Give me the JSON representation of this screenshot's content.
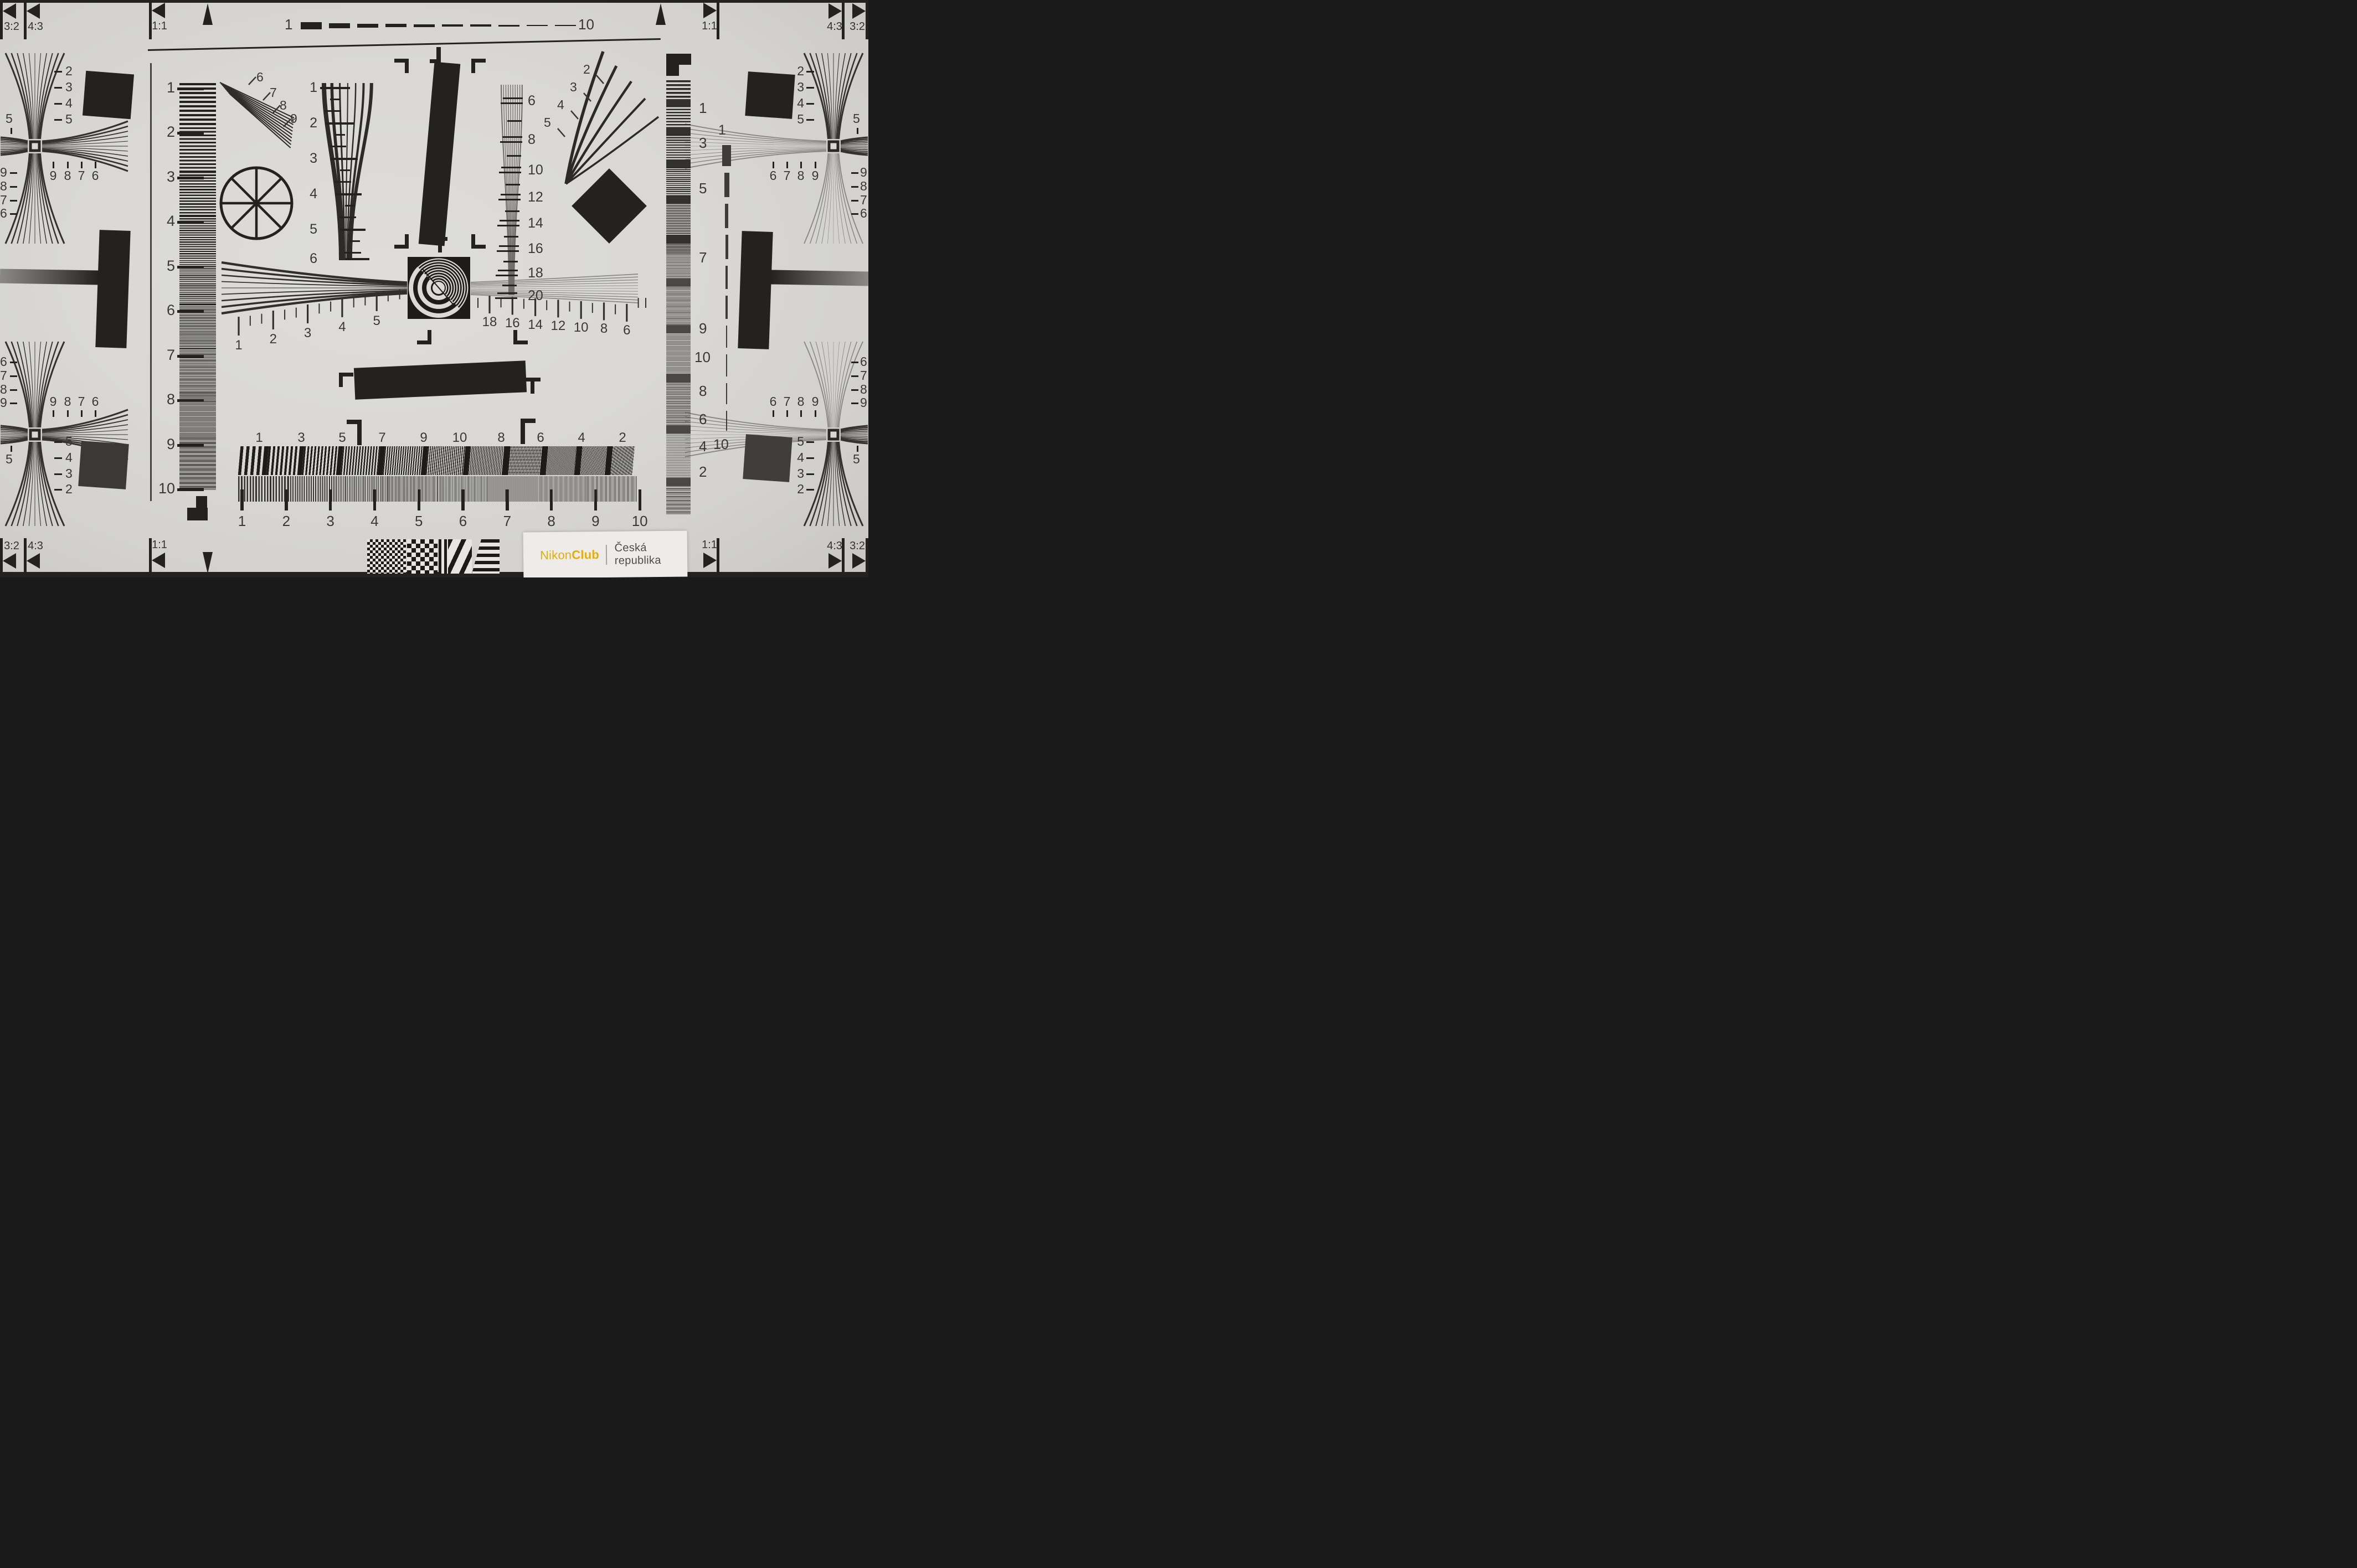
{
  "chart": {
    "type": "lens-resolution-test-chart",
    "corner_labels": {
      "r32": "3:2",
      "r43": "4:3",
      "r11": "1:1"
    },
    "logo": {
      "brand_a": "Nikon",
      "brand_b": "Club",
      "region": "Česká republika"
    },
    "colors": {
      "brand_yellow": "#e2ae0b",
      "ink": "#242220",
      "paper": "#d8d7d4",
      "label_ink": "#3a3734"
    },
    "scales": {
      "top_dashed": {
        "start": "1",
        "end": "10"
      },
      "right_dashed": {
        "start": "1",
        "end": "10"
      },
      "left_column": [
        "1",
        "2",
        "3",
        "4",
        "5",
        "6",
        "7",
        "8",
        "9",
        "10"
      ],
      "right_column": [
        "1",
        "3",
        "5",
        "7",
        "9",
        "10",
        "8",
        "6",
        "4",
        "2"
      ],
      "center_wedge": [
        "1",
        "2",
        "3",
        "4",
        "5",
        "6"
      ],
      "center_right_wedge": [
        "6",
        "8",
        "10",
        "12",
        "14",
        "16",
        "18",
        "20"
      ],
      "fan_upper_left": [
        "6",
        "7",
        "8",
        "9"
      ],
      "fan_plume_right": [
        "2",
        "3",
        "4",
        "5"
      ],
      "ruler_left": [
        "1",
        "2",
        "3",
        "4",
        "5"
      ],
      "ruler_right": [
        "18",
        "16",
        "14",
        "12",
        "10",
        "8",
        "6"
      ],
      "bars_top": [
        "1",
        "3",
        "5",
        "7",
        "9",
        "10",
        "8",
        "6",
        "4",
        "2"
      ],
      "bars_bottom_ruler": [
        "1",
        "2",
        "3",
        "4",
        "5",
        "6",
        "7",
        "8",
        "9",
        "10"
      ]
    },
    "stars": {
      "top_left": {
        "vertical": [
          "2",
          "3",
          "4",
          "5"
        ],
        "outer": "5",
        "row": [
          "9",
          "8",
          "7",
          "6"
        ],
        "side": [
          "9",
          "8",
          "7",
          "6"
        ]
      },
      "top_right": {
        "vertical": [
          "2",
          "3",
          "4",
          "5"
        ],
        "outer": "5",
        "row": [
          "6",
          "7",
          "8",
          "9"
        ],
        "side": [
          "9",
          "8",
          "7",
          "6"
        ]
      },
      "bottom_left": {
        "vertical": [
          "5",
          "4",
          "3",
          "2"
        ],
        "outer": "5",
        "row": [
          "9",
          "8",
          "7",
          "6"
        ],
        "side": [
          "6",
          "7",
          "8",
          "9"
        ]
      },
      "bottom_right": {
        "vertical": [
          "5",
          "4",
          "3",
          "2"
        ],
        "outer": "5",
        "row": [
          "6",
          "7",
          "8",
          "9"
        ],
        "side": [
          "6",
          "7",
          "8",
          "9"
        ]
      }
    }
  }
}
